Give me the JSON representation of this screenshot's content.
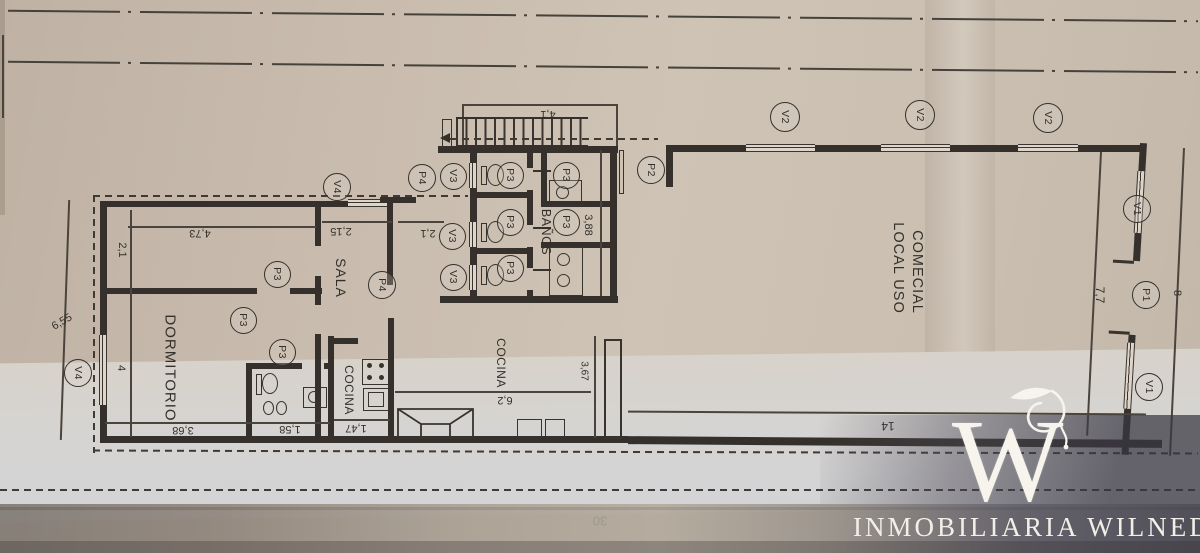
{
  "scene": {
    "description": "Photographed architectural floor plan on beige paper"
  },
  "colors": {
    "ink": "#33302b",
    "wall": "#35302b",
    "paper_top": "#c9bcae",
    "paper_mid": "#d6d4d2",
    "shadow_band": "#5f5e66",
    "watermark": "#f7f4ee"
  },
  "plan": {
    "rooms": [
      {
        "label": "DORMITORIO",
        "x": 170,
        "y": 368,
        "rot": 90,
        "fs": 15,
        "ls": 1
      },
      {
        "label": "SALA",
        "x": 341,
        "y": 278,
        "rot": 90,
        "fs": 14,
        "ls": 1
      },
      {
        "label": "COCINA",
        "x": 349,
        "y": 390,
        "rot": 90,
        "fs": 12,
        "ls": 0.5
      },
      {
        "label": "COCINA",
        "x": 501,
        "y": 363,
        "rot": 90,
        "fs": 12,
        "ls": 0.5
      },
      {
        "label": "BAÑOS",
        "x": 546,
        "y": 232,
        "rot": 90,
        "fs": 12.5,
        "ls": 0.5
      },
      {
        "label": "LOCAL USO",
        "x": 898,
        "y": 268,
        "rot": 90,
        "fs": 14.5,
        "ls": 1
      },
      {
        "label": "COMECIAL",
        "x": 917,
        "y": 272,
        "rot": 90,
        "fs": 14.5,
        "ls": 1
      }
    ],
    "dimensions": [
      {
        "label": "4,1",
        "x": 548,
        "y": 114,
        "rot": 180,
        "fs": 11
      },
      {
        "label": "4,73",
        "x": 200,
        "y": 233,
        "rot": 180,
        "fs": 11
      },
      {
        "label": "2,1",
        "x": 122,
        "y": 250,
        "rot": 90,
        "fs": 11
      },
      {
        "label": "6,55",
        "x": 62,
        "y": 322,
        "rot": -30,
        "fs": 11
      },
      {
        "label": "4",
        "x": 121,
        "y": 368,
        "rot": 90,
        "fs": 11
      },
      {
        "label": "3,68",
        "x": 183,
        "y": 430,
        "rot": 180,
        "fs": 11
      },
      {
        "label": "1,58",
        "x": 290,
        "y": 429,
        "rot": 180,
        "fs": 11
      },
      {
        "label": "2,15",
        "x": 341,
        "y": 231,
        "rot": 180,
        "fs": 11
      },
      {
        "label": "2,1",
        "x": 428,
        "y": 233,
        "rot": 180,
        "fs": 11
      },
      {
        "label": "1,47",
        "x": 356,
        "y": 428,
        "rot": 180,
        "fs": 11
      },
      {
        "label": "3,88",
        "x": 588,
        "y": 225,
        "rot": 90,
        "fs": 11
      },
      {
        "label": "3,67",
        "x": 584,
        "y": 371,
        "rot": 90,
        "fs": 10
      },
      {
        "label": "6,2",
        "x": 505,
        "y": 400,
        "rot": 180,
        "fs": 11
      },
      {
        "label": "14",
        "x": 888,
        "y": 426,
        "rot": 180,
        "fs": 12
      },
      {
        "label": "7,7",
        "x": 1100,
        "y": 295,
        "rot": 90,
        "fs": 12
      },
      {
        "label": "8",
        "x": 1177,
        "y": 293,
        "rot": 90,
        "fs": 11
      },
      {
        "label": "30",
        "x": 600,
        "y": 521,
        "rot": 180,
        "fs": 13
      }
    ],
    "markers": [
      {
        "label": "V2",
        "x": 785,
        "y": 117,
        "d": 30
      },
      {
        "label": "V2",
        "x": 920,
        "y": 115,
        "d": 30
      },
      {
        "label": "V2",
        "x": 1048,
        "y": 118,
        "d": 30
      },
      {
        "label": "V4",
        "x": 337,
        "y": 187,
        "d": 28
      },
      {
        "label": "V4",
        "x": 78,
        "y": 373,
        "d": 28
      },
      {
        "label": "P4",
        "x": 422,
        "y": 178,
        "d": 28
      },
      {
        "label": "P4",
        "x": 382,
        "y": 285,
        "d": 28
      },
      {
        "label": "V3",
        "x": 453,
        "y": 176,
        "d": 27
      },
      {
        "label": "V3",
        "x": 452,
        "y": 236,
        "d": 27
      },
      {
        "label": "V3",
        "x": 453,
        "y": 277,
        "d": 27
      },
      {
        "label": "P3",
        "x": 510,
        "y": 175,
        "d": 27
      },
      {
        "label": "P3",
        "x": 566,
        "y": 175,
        "d": 27
      },
      {
        "label": "P3",
        "x": 510,
        "y": 222,
        "d": 27
      },
      {
        "label": "P3",
        "x": 566,
        "y": 222,
        "d": 27
      },
      {
        "label": "P3",
        "x": 510,
        "y": 268,
        "d": 27
      },
      {
        "label": "P3",
        "x": 277,
        "y": 274,
        "d": 27
      },
      {
        "label": "P3",
        "x": 243,
        "y": 320,
        "d": 27
      },
      {
        "label": "P3",
        "x": 282,
        "y": 352,
        "d": 27
      },
      {
        "label": "P2",
        "x": 651,
        "y": 170,
        "d": 28
      },
      {
        "label": "P1",
        "x": 1146,
        "y": 295,
        "d": 28
      },
      {
        "label": "V1",
        "x": 1137,
        "y": 209,
        "d": 28
      },
      {
        "label": "V1",
        "x": 1149,
        "y": 387,
        "d": 28
      }
    ]
  },
  "watermark": {
    "letter": "W",
    "name": "INMOBILIARIA WILNEDER"
  }
}
